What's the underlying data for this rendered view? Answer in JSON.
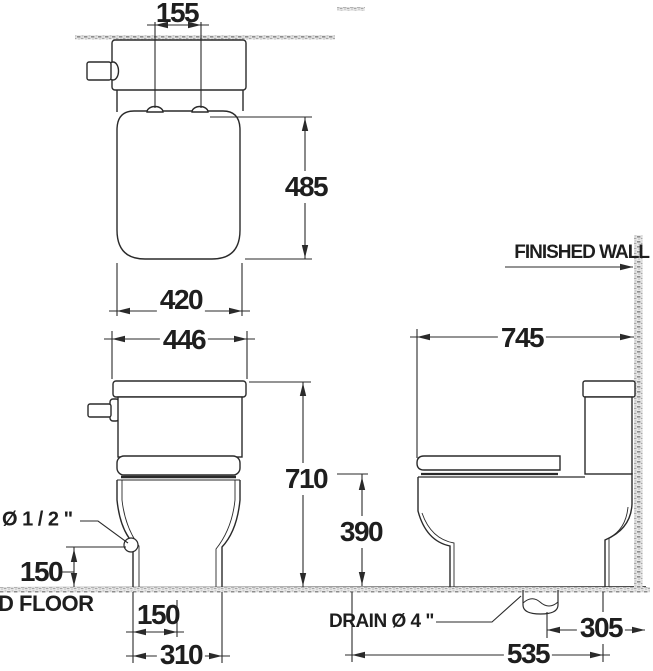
{
  "drawing": {
    "subject": "two-piece toilet installation dimension drawing",
    "views": [
      "plan view",
      "front view",
      "side view"
    ]
  },
  "labels": {
    "finished_wall": "FINISHED WALL",
    "finished_floor": "D FLOOR",
    "supply_diameter": "Ø 1 / 2 \"",
    "drain_diameter": "DRAIN Ø 4 \""
  },
  "dimensions": {
    "hinge_spacing": "155",
    "tank_depth_plan": "485",
    "tank_width": "420",
    "overall_width": "446",
    "overall_height": "710",
    "supply_height": "150",
    "base_setback": "150",
    "base_width": "310",
    "overall_depth": "745",
    "bowl_rim_height": "390",
    "drain_to_wall": "305",
    "base_length": "535"
  }
}
